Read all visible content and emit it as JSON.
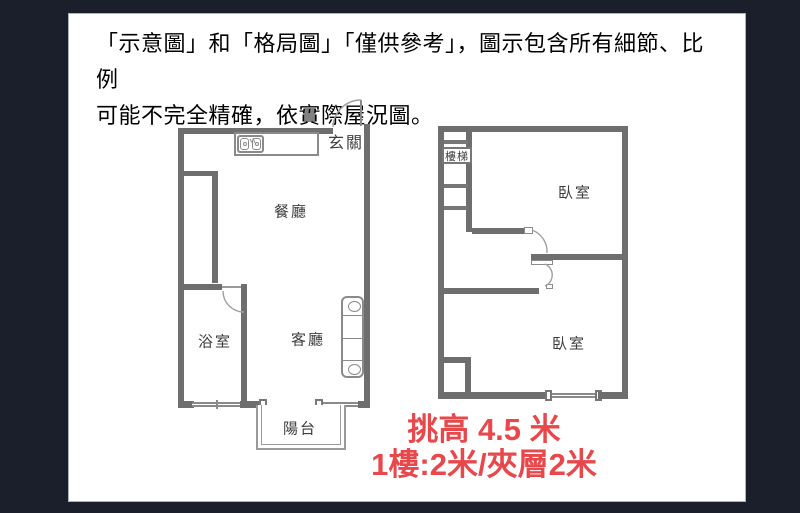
{
  "disclaimer": {
    "line1": "「示意圖」和「格局圖」「僅供參考」，圖示包含所有細節、比例",
    "line2": "可能不完全精確，依實際屋況圖。"
  },
  "plan_left": {
    "entry": "玄關",
    "dining": "餐廳",
    "bath": "浴室",
    "living": "客廳",
    "balcony": "陽台"
  },
  "plan_right": {
    "stairs": "樓梯",
    "bedroom_upper": "臥室",
    "bedroom_lower": "臥室"
  },
  "note": {
    "line1": "挑高 4.5 米",
    "line2": "1樓:2米/夾層2米"
  },
  "colors": {
    "background": "#1a1f2b",
    "panel": "#ffffff",
    "wall": "#6e6e6e",
    "note_red": "#e8484b",
    "text": "#000000"
  }
}
